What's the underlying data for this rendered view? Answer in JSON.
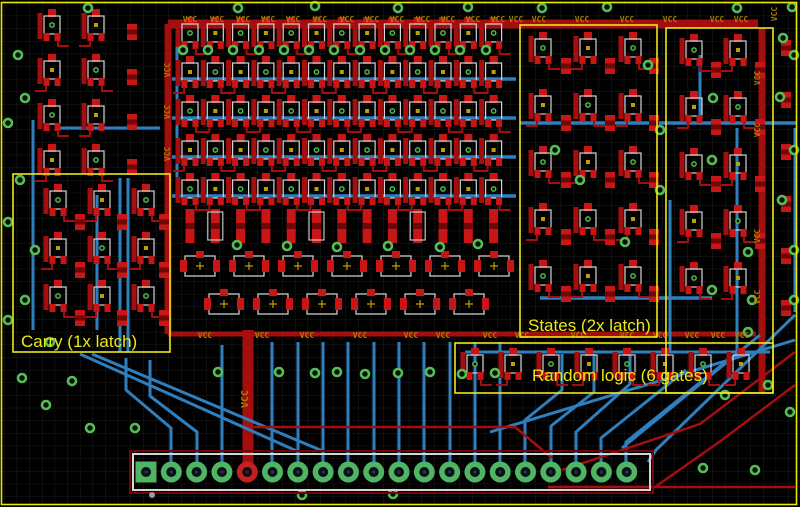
{
  "view": {
    "tool": "pcb-layout-canvas",
    "width": 800,
    "height": 507,
    "grid_spacing": 12.65
  },
  "colors": {
    "background": "#000000",
    "grid": "#1c1c1c",
    "board_outline": "#e8e800",
    "copper_top": "#a50e0e",
    "pad_top": "#c81616",
    "copper_dark": "#6e0707",
    "copper_bottom": "#2f7fbe",
    "via_green": "#55bd55",
    "pad_green": "#4fb464",
    "pin_vcc_red": "#c32020",
    "pin_hole": "#0a1016",
    "silkscreen": "#d4d4d4",
    "origin_cross": "#b8a200",
    "net_label": "#a87c00",
    "annotation_yellow": "#ece818",
    "grey_dot": "#9a9a9a"
  },
  "annotations": {
    "items": [
      {
        "id": "carry",
        "label": "Carry (1x latch)",
        "boxes": [
          [
            13,
            174,
            157,
            178
          ]
        ],
        "text_pos": [
          21,
          347
        ]
      },
      {
        "id": "states",
        "label": "States (2x latch)",
        "boxes": [
          [
            520,
            25,
            137,
            312
          ]
        ],
        "text_pos": [
          528,
          331
        ]
      },
      {
        "id": "random",
        "label": "Random logic (6 gates)",
        "boxes": [
          [
            666,
            28,
            107,
            365
          ],
          [
            455,
            343,
            318,
            50
          ]
        ],
        "text_pos": [
          532,
          381
        ]
      }
    ]
  },
  "net_labels": {
    "text": "VCC",
    "top_row_y": 22,
    "top_row_x": [
      190,
      217,
      243,
      268,
      293,
      320,
      347,
      372,
      397,
      423,
      448,
      473,
      498,
      516,
      539,
      582,
      627,
      670,
      717,
      741
    ],
    "mid_row_y": 338,
    "mid_row_x": [
      205,
      262,
      307,
      360,
      411,
      443,
      490,
      522,
      578,
      627,
      660,
      692,
      718,
      742
    ],
    "vertical": [
      [
        170,
        70
      ],
      [
        170,
        112
      ],
      [
        170,
        154
      ],
      [
        760,
        78
      ],
      [
        760,
        130
      ],
      [
        760,
        236
      ],
      [
        760,
        297
      ],
      [
        777,
        14
      ]
    ],
    "vertical_big": [
      248,
      399
    ]
  },
  "connector": {
    "pins": 20,
    "pitch": 25.3,
    "first_x": 146,
    "cy": 472,
    "square_first_pin": true,
    "vcc_pin": 5,
    "pad_r": 10.5,
    "hole_r": 5,
    "silk_box": [
      133,
      454,
      517,
      36
    ],
    "outer_box": [
      130,
      451,
      523,
      42
    ]
  },
  "component_groups": [
    {
      "name": "left-column-a",
      "painter": "sot",
      "origin": [
        52,
        25
      ],
      "cols": 2,
      "rows": 4,
      "dx": 44,
      "dy": 45
    },
    {
      "name": "left-column-b",
      "painter": "chip",
      "origin": [
        132,
        32
      ],
      "cols": 1,
      "rows": 4,
      "dx": 0,
      "dy": 45
    },
    {
      "name": "carry-cells-a",
      "painter": "sot",
      "origin": [
        58,
        200
      ],
      "cols": 3,
      "rows": 3,
      "dx": 44,
      "dy": 48
    },
    {
      "name": "carry-cells-b",
      "painter": "chip",
      "origin": [
        80,
        222
      ],
      "cols": 3,
      "rows": 3,
      "dx": 42,
      "dy": 48
    },
    {
      "name": "register-array",
      "painter": "sot",
      "origin": [
        190,
        33
      ],
      "cols": 13,
      "rows": 5,
      "dx": 25.3,
      "dy": 39
    },
    {
      "name": "array-tall-row",
      "painter": "tall",
      "origin": [
        190,
        226
      ],
      "cols": 13,
      "rows": 1,
      "dx": 25.3,
      "dy": 0
    },
    {
      "name": "array-wide-row-a",
      "painter": "wide",
      "origin": [
        200,
        266
      ],
      "cols": 7,
      "rows": 1,
      "dx": 49,
      "dy": 0
    },
    {
      "name": "array-wide-row-b",
      "painter": "wide",
      "origin": [
        224,
        304
      ],
      "cols": 6,
      "rows": 1,
      "dx": 49,
      "dy": 0
    },
    {
      "name": "states-cells-a",
      "painter": "sot",
      "origin": [
        543,
        48
      ],
      "cols": 3,
      "rows": 5,
      "dx": 45,
      "dy": 57
    },
    {
      "name": "states-cells-b",
      "painter": "chip",
      "origin": [
        566,
        66
      ],
      "cols": 3,
      "rows": 5,
      "dx": 44,
      "dy": 57
    },
    {
      "name": "random-right-a",
      "painter": "sot",
      "origin": [
        694,
        50
      ],
      "cols": 2,
      "rows": 5,
      "dx": 44,
      "dy": 57
    },
    {
      "name": "random-right-b",
      "painter": "chip",
      "origin": [
        716,
        70
      ],
      "cols": 2,
      "rows": 4,
      "dx": 44,
      "dy": 57
    },
    {
      "name": "random-strip",
      "painter": "sot",
      "origin": [
        475,
        364
      ],
      "cols": 8,
      "rows": 1,
      "dx": 38,
      "dy": 0
    },
    {
      "name": "right-edge-column",
      "painter": "chip",
      "origin": [
        786,
        48
      ],
      "cols": 1,
      "rows": 6,
      "dx": 0,
      "dy": 52
    }
  ],
  "traces": {
    "blue": [
      {
        "pts": [
          [
            172,
            79
          ],
          [
            516,
            79
          ]
        ],
        "w": 3.5
      },
      {
        "pts": [
          [
            172,
            118
          ],
          [
            516,
            118
          ]
        ],
        "w": 3.5
      },
      {
        "pts": [
          [
            172,
            157
          ],
          [
            516,
            157
          ]
        ],
        "w": 3.5
      },
      {
        "pts": [
          [
            172,
            196
          ],
          [
            516,
            196
          ]
        ],
        "w": 3.5
      },
      {
        "pts": [
          [
            520,
            123
          ],
          [
            796,
            123
          ]
        ],
        "w": 3.5
      },
      {
        "pts": [
          [
            540,
            298
          ],
          [
            712,
            298
          ]
        ],
        "w": 3.5
      },
      {
        "pts": [
          [
            465,
            352
          ],
          [
            770,
            352
          ]
        ],
        "w": 3
      },
      {
        "pts": [
          [
            60,
            128
          ],
          [
            160,
            128
          ]
        ],
        "w": 3
      },
      {
        "pts": [
          [
            177,
            33
          ],
          [
            177,
            196
          ]
        ],
        "w": 3
      },
      {
        "pts": [
          [
            97,
            195
          ],
          [
            97,
            330
          ]
        ],
        "w": 3
      },
      {
        "pts": [
          [
            120,
            178
          ],
          [
            120,
            352
          ]
        ],
        "w": 3
      },
      {
        "pts": [
          [
            128,
            178
          ],
          [
            128,
            352
          ]
        ],
        "w": 3
      },
      {
        "pts": [
          [
            737,
            128
          ],
          [
            737,
            352
          ]
        ],
        "w": 3
      },
      {
        "pts": [
          [
            795,
            128
          ],
          [
            795,
            312
          ]
        ],
        "w": 3
      },
      {
        "pts": [
          [
            670,
            200
          ],
          [
            670,
            352
          ]
        ],
        "w": 3
      },
      {
        "pts": [
          [
            700,
            55
          ],
          [
            700,
            123
          ]
        ],
        "w": 3
      },
      {
        "pts": [
          [
            33,
            120
          ],
          [
            33,
            330
          ]
        ],
        "w": 3
      },
      {
        "pts": [
          [
            272,
            342
          ],
          [
            272,
            468
          ]
        ],
        "w": 3
      },
      {
        "pts": [
          [
            298,
            342
          ],
          [
            298,
            468
          ]
        ],
        "w": 3
      },
      {
        "pts": [
          [
            323,
            342
          ],
          [
            323,
            468
          ]
        ],
        "w": 3
      },
      {
        "pts": [
          [
            348,
            342
          ],
          [
            348,
            468
          ]
        ],
        "w": 3
      },
      {
        "pts": [
          [
            374,
            342
          ],
          [
            374,
            468
          ]
        ],
        "w": 3
      },
      {
        "pts": [
          [
            399,
            342
          ],
          [
            399,
            468
          ]
        ],
        "w": 3
      },
      {
        "pts": [
          [
            424,
            342
          ],
          [
            424,
            468
          ]
        ],
        "w": 3
      },
      {
        "pts": [
          [
            450,
            342
          ],
          [
            450,
            468
          ]
        ],
        "w": 3
      },
      {
        "pts": [
          [
            475,
            342
          ],
          [
            475,
            468
          ]
        ],
        "w": 3
      },
      {
        "pts": [
          [
            500,
            342
          ],
          [
            500,
            468
          ]
        ],
        "w": 3
      },
      {
        "pts": [
          [
            171,
            468
          ],
          [
            171,
            428
          ],
          [
            126,
            390
          ],
          [
            126,
            358
          ]
        ],
        "w": 3
      },
      {
        "pts": [
          [
            197,
            468
          ],
          [
            197,
            432
          ],
          [
            150,
            396
          ],
          [
            150,
            360
          ]
        ],
        "w": 3
      },
      {
        "pts": [
          [
            222,
            468
          ],
          [
            222,
            345
          ]
        ],
        "w": 3
      },
      {
        "pts": [
          [
            80,
            354
          ],
          [
            299,
            452
          ]
        ],
        "w": 3
      },
      {
        "pts": [
          [
            92,
            354
          ],
          [
            325,
            452
          ]
        ],
        "w": 3
      },
      {
        "pts": [
          [
            525,
            468
          ],
          [
            525,
            420
          ],
          [
            562,
            390
          ],
          [
            562,
            354
          ]
        ],
        "w": 3
      },
      {
        "pts": [
          [
            551,
            468
          ],
          [
            551,
            426
          ],
          [
            594,
            392
          ],
          [
            594,
            354
          ]
        ],
        "w": 3
      },
      {
        "pts": [
          [
            576,
            468
          ],
          [
            576,
            432
          ],
          [
            630,
            384
          ],
          [
            630,
            354
          ]
        ],
        "w": 3
      },
      {
        "pts": [
          [
            601,
            468
          ],
          [
            601,
            438
          ],
          [
            686,
            370
          ]
        ],
        "w": 3
      },
      {
        "pts": [
          [
            626,
            468
          ],
          [
            626,
            442
          ],
          [
            728,
            360
          ]
        ],
        "w": 3
      },
      {
        "pts": [
          [
            795,
            315
          ],
          [
            656,
            450
          ],
          [
            648,
            462
          ]
        ],
        "w": 3
      },
      {
        "pts": [
          [
            760,
            335
          ],
          [
            622,
            448
          ]
        ],
        "w": 3
      },
      {
        "pts": [
          [
            490,
            432
          ],
          [
            795,
            340
          ]
        ],
        "w": 3
      }
    ],
    "red": [
      {
        "pts": [
          [
            168,
            24
          ],
          [
            758,
            24
          ]
        ],
        "w": 9
      },
      {
        "pts": [
          [
            168,
            24
          ],
          [
            168,
            334
          ]
        ],
        "w": 7
      },
      {
        "pts": [
          [
            762,
            28
          ],
          [
            762,
            392
          ]
        ],
        "w": 7
      },
      {
        "pts": [
          [
            168,
            334
          ],
          [
            756,
            334
          ]
        ],
        "w": 5
      },
      {
        "pts": [
          [
            248,
            330
          ],
          [
            248,
            466
          ]
        ],
        "w": 11
      },
      {
        "pts": [
          [
            253,
            427
          ],
          [
            515,
            427
          ],
          [
            552,
            458
          ]
        ],
        "w": 2.5
      },
      {
        "pts": [
          [
            795,
            352
          ],
          [
            700,
            424
          ],
          [
            562,
            470
          ]
        ],
        "w": 2.5
      },
      {
        "pts": [
          [
            795,
            385
          ],
          [
            722,
            440
          ],
          [
            655,
            487
          ],
          [
            548,
            487
          ]
        ],
        "w": 2.5
      },
      {
        "pts": [
          [
            548,
            487
          ],
          [
            795,
            487
          ]
        ],
        "w": 2.5
      }
    ]
  },
  "vias": [
    [
      88,
      8
    ],
    [
      238,
      8
    ],
    [
      315,
      6
    ],
    [
      398,
      8
    ],
    [
      468,
      7
    ],
    [
      542,
      8
    ],
    [
      607,
      7
    ],
    [
      737,
      8
    ],
    [
      792,
      7
    ],
    [
      183,
      50
    ],
    [
      208,
      50
    ],
    [
      233,
      50
    ],
    [
      259,
      50
    ],
    [
      284,
      50
    ],
    [
      309,
      50
    ],
    [
      334,
      50
    ],
    [
      360,
      50
    ],
    [
      385,
      50
    ],
    [
      410,
      50
    ],
    [
      435,
      50
    ],
    [
      460,
      50
    ],
    [
      486,
      50
    ],
    [
      237,
      245
    ],
    [
      287,
      246
    ],
    [
      337,
      247
    ],
    [
      388,
      246
    ],
    [
      440,
      247
    ],
    [
      478,
      244
    ],
    [
      218,
      372
    ],
    [
      279,
      372
    ],
    [
      315,
      373
    ],
    [
      337,
      372
    ],
    [
      365,
      374
    ],
    [
      398,
      373
    ],
    [
      430,
      372
    ],
    [
      462,
      374
    ],
    [
      495,
      373
    ],
    [
      8,
      123
    ],
    [
      25,
      98
    ],
    [
      8,
      222
    ],
    [
      20,
      180
    ],
    [
      8,
      320
    ],
    [
      25,
      300
    ],
    [
      50,
      342
    ],
    [
      22,
      378
    ],
    [
      72,
      381
    ],
    [
      46,
      405
    ],
    [
      90,
      428
    ],
    [
      135,
      428
    ],
    [
      18,
      55
    ],
    [
      35,
      250
    ],
    [
      783,
      38
    ],
    [
      794,
      55
    ],
    [
      780,
      97
    ],
    [
      794,
      150
    ],
    [
      782,
      200
    ],
    [
      794,
      250
    ],
    [
      752,
      300
    ],
    [
      794,
      300
    ],
    [
      748,
      332
    ],
    [
      712,
      290
    ],
    [
      660,
      130
    ],
    [
      713,
      98
    ],
    [
      648,
      65
    ],
    [
      660,
      190
    ],
    [
      712,
      160
    ],
    [
      748,
      252
    ],
    [
      580,
      180
    ],
    [
      625,
      242
    ],
    [
      555,
      150
    ],
    [
      703,
      468
    ],
    [
      755,
      470
    ],
    [
      790,
      412
    ],
    [
      768,
      385
    ],
    [
      725,
      395
    ],
    [
      302,
      495
    ],
    [
      393,
      494
    ]
  ],
  "extras": {
    "grey_dot": [
      152,
      495
    ],
    "board_outline_rect": [
      1.5,
      2.5,
      795,
      502
    ]
  }
}
